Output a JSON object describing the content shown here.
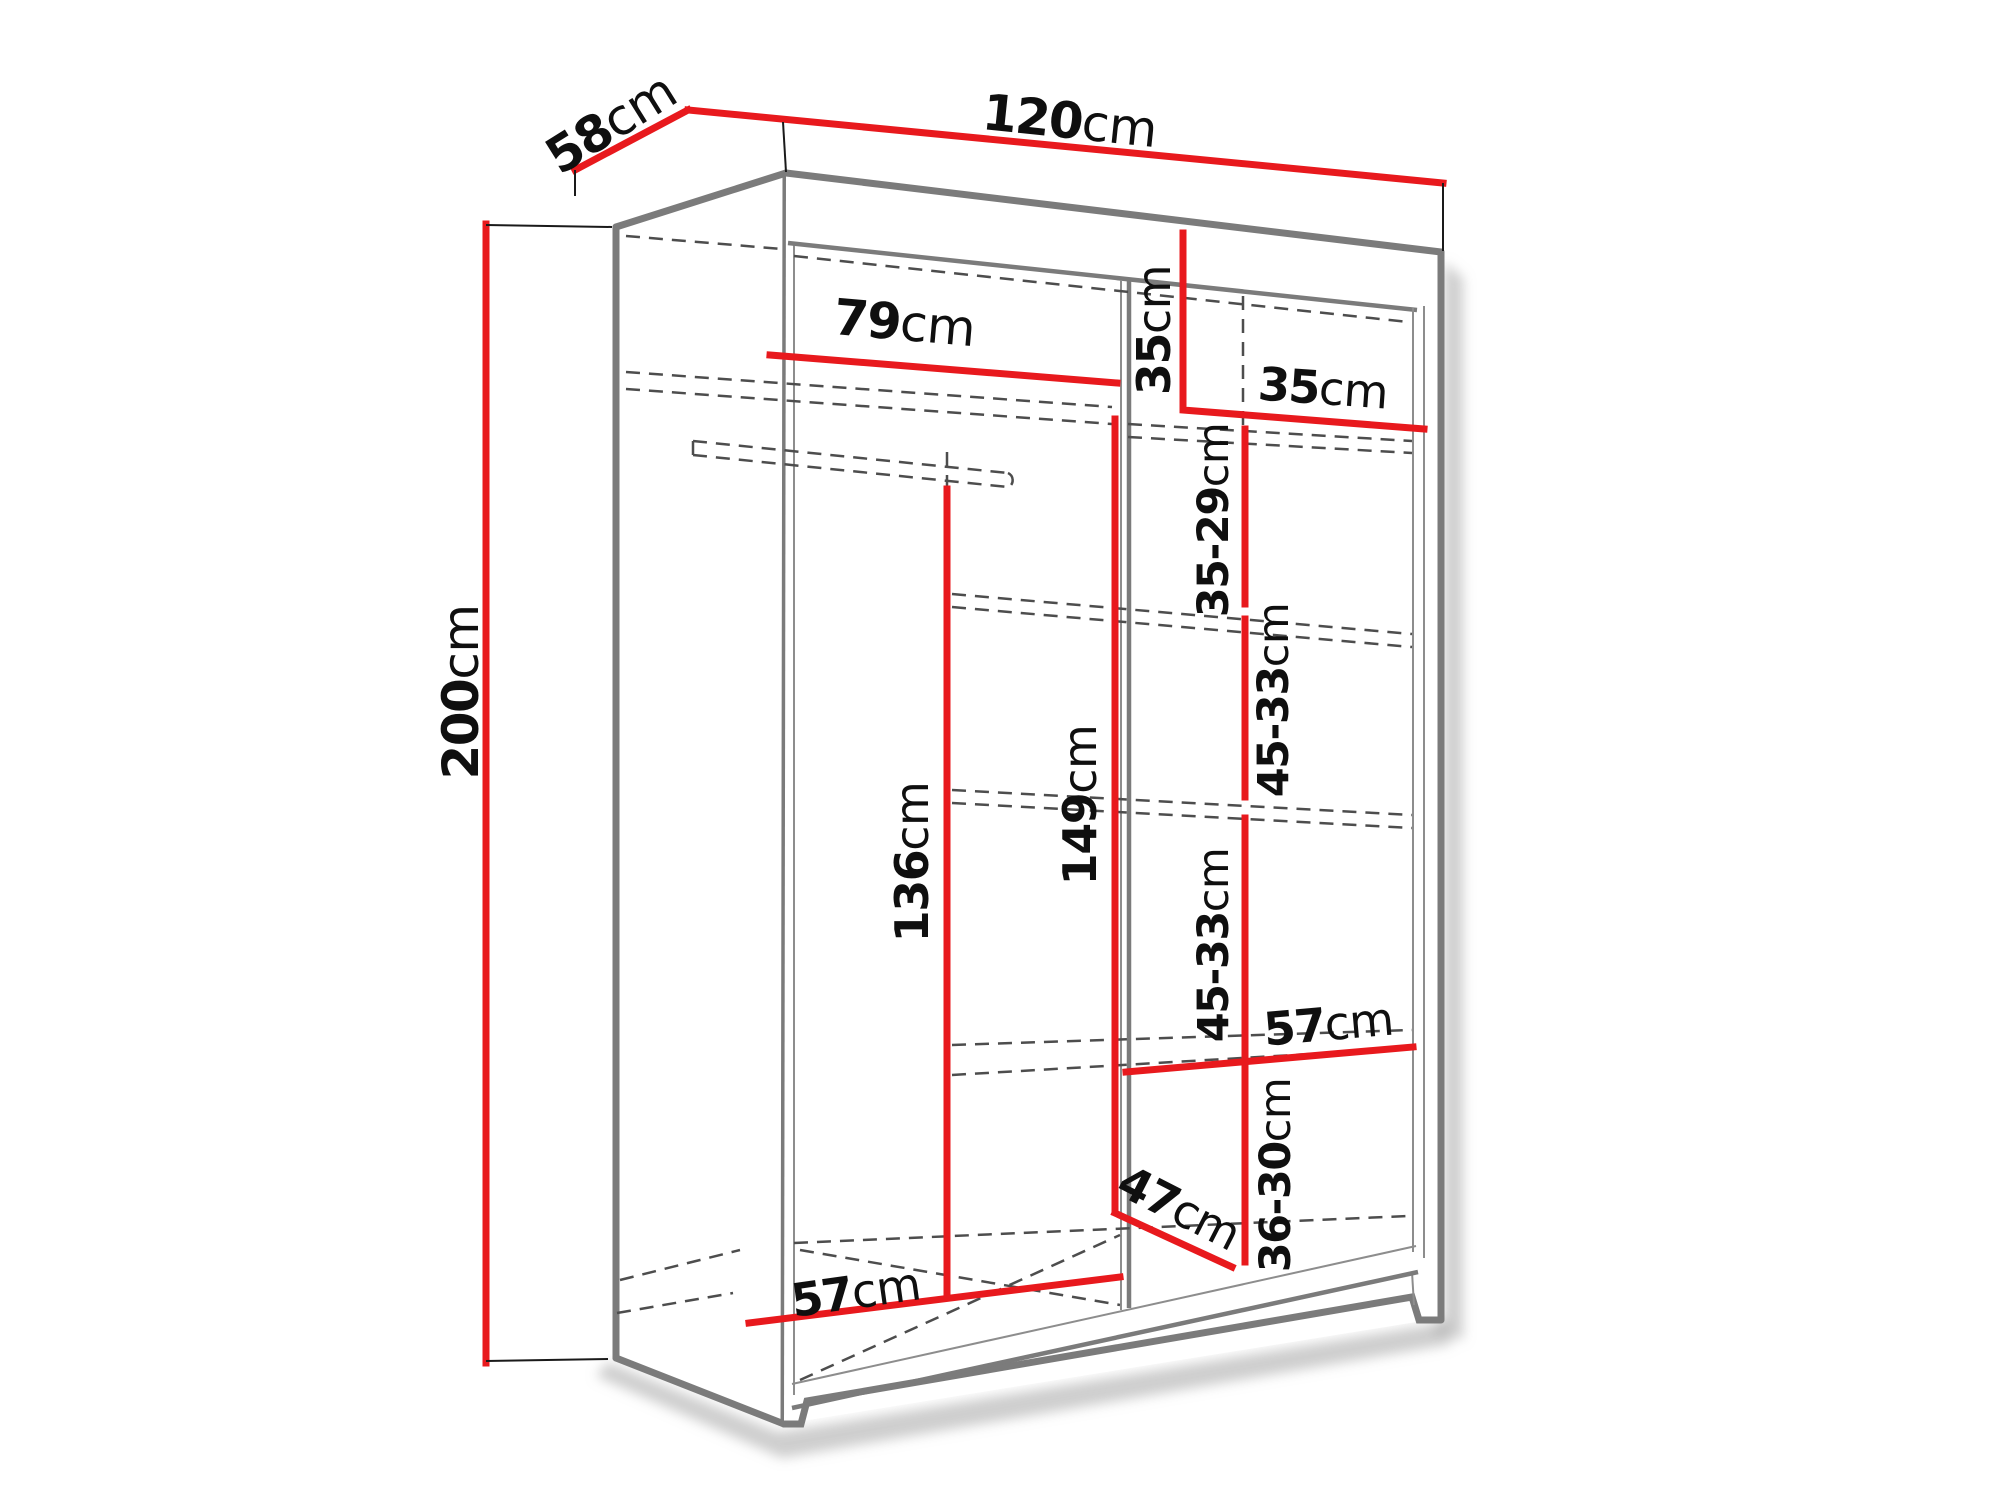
{
  "diagram": {
    "title": "wardrobe-interior-dimension-diagram",
    "unit": "cm",
    "colors": {
      "dimension": "#e8191d",
      "structure": "#7b7b7b",
      "text": "#0f0f0f",
      "background": "#ffffff"
    },
    "labels": {
      "depth": {
        "value": "58",
        "unit": "cm"
      },
      "width": {
        "value": "120",
        "unit": "cm"
      },
      "height": {
        "value": "200",
        "unit": "cm"
      },
      "left_width": {
        "value": "79",
        "unit": "cm"
      },
      "top_cubby_height": {
        "value": "35",
        "unit": "cm"
      },
      "top_cubby_width": {
        "value": "35",
        "unit": "cm"
      },
      "shelf_gap_1": {
        "value": "35-29",
        "unit": "cm"
      },
      "shelf_gap_2": {
        "value": "45-33",
        "unit": "cm"
      },
      "shelf_gap_3": {
        "value": "45-33",
        "unit": "cm"
      },
      "hanging_height": {
        "value": "136",
        "unit": "cm"
      },
      "column_height": {
        "value": "149",
        "unit": "cm"
      },
      "shelf_width": {
        "value": "57",
        "unit": "cm"
      },
      "bottom_gap": {
        "value": "36-30",
        "unit": "cm"
      },
      "bottom_width": {
        "value": "57",
        "unit": "cm"
      },
      "bottom_diagonal": {
        "value": "47",
        "unit": "cm"
      }
    }
  }
}
